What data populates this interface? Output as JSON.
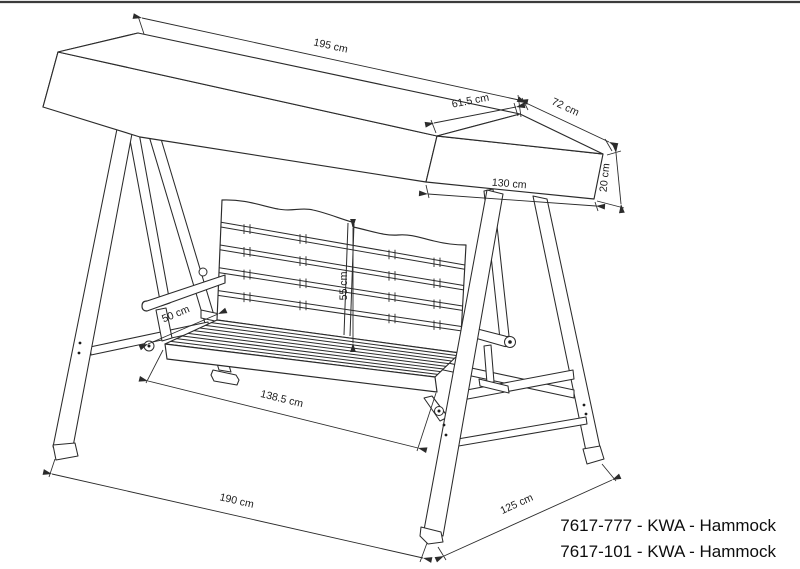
{
  "drawing": {
    "subject": "Swing hammock with canopy - technical line drawing",
    "background": "#ffffff",
    "line_color": "#2b2b2b"
  },
  "dimensions": {
    "canopy_length": "195 cm",
    "canopy_depth": "61.5 cm",
    "canopy_hip_edge": "72 cm",
    "canopy_lower_edge": "130 cm",
    "canopy_height": "20 cm",
    "backrest_height": "55 cm",
    "seat_depth": "50 cm",
    "seat_width": "138.5 cm",
    "frame_width": "190 cm",
    "frame_depth": "125 cm"
  },
  "product_codes": {
    "line1": "7617-777 - KWA - Hammock",
    "line2": "7617-101 - KWA - Hammock"
  }
}
